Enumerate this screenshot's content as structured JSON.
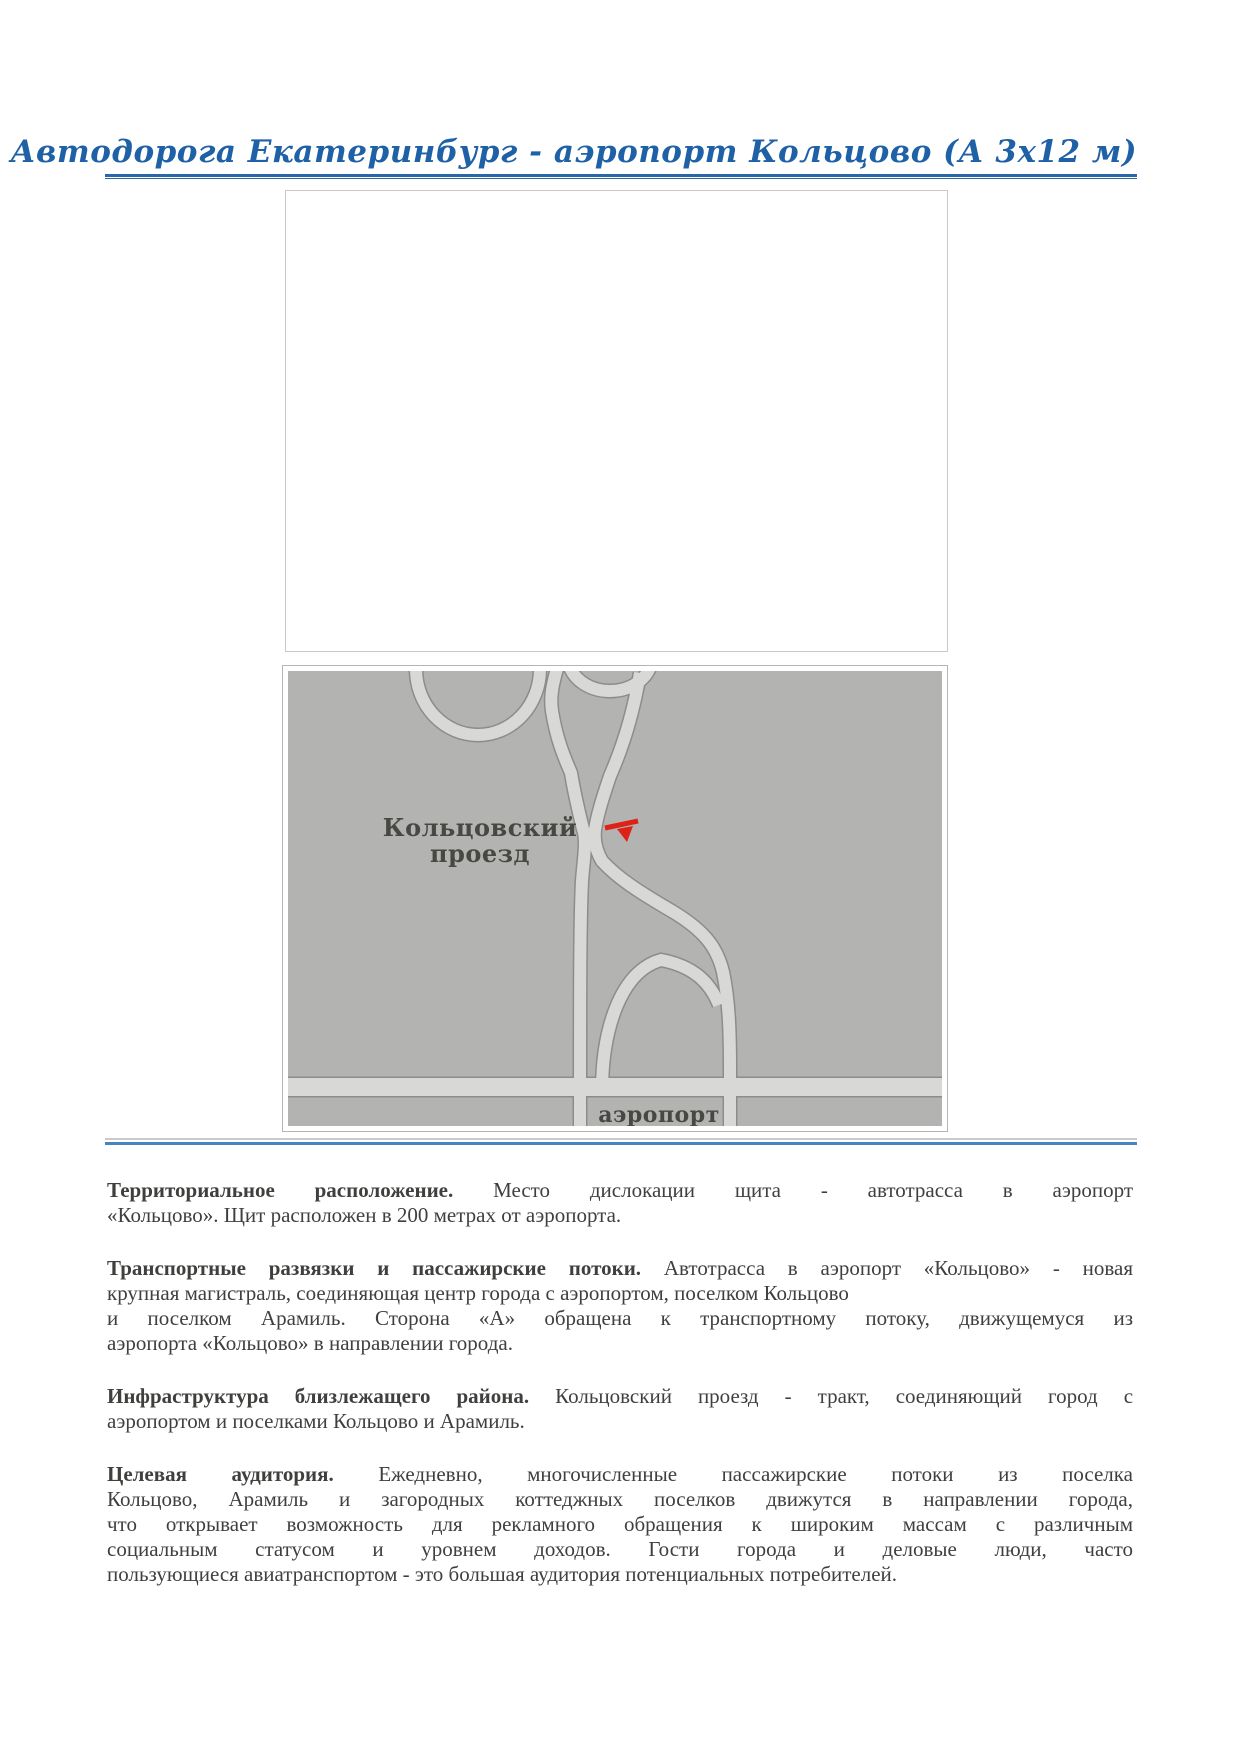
{
  "header": {
    "title": "Автодорога Екатеринбург - аэропорт Кольцово (А 3х12 м)",
    "title_color": "#1f61a6",
    "rule_color": "#2a67a6"
  },
  "map": {
    "road_label_line1": "Кольцовский",
    "road_label_line2": "проезд",
    "airport_label": "аэропорт",
    "colors": {
      "background": "#b3b3b1",
      "road_fill": "#d8d8d6",
      "road_casing": "#8c8c8a",
      "marker": "#dd2318",
      "label_text": "#474743"
    }
  },
  "separator": {
    "gray": "#cacaca",
    "blue": "#4683bf"
  },
  "body": {
    "paragraphs": [
      {
        "heading": "Территориальное расположение.",
        "lines": [
          "Место дислокации щита - автотрасса в аэропорт",
          "«Кольцово». Щит расположен в 200 метрах от аэропорта."
        ]
      },
      {
        "heading": "Транспортные развязки и пассажирские потоки.",
        "lines": [
          "Автотрасса в аэропорт «Кольцово» - новая",
          "крупная магистраль, соединяющая центр города с аэропортом, поселком Кольцово",
          "и поселком Арамиль. Сторона «А» обращена к транспортному потоку, движущемуся из",
          "аэропорта «Кольцово» в направлении города."
        ]
      },
      {
        "heading": "Инфраструктура близлежащего района.",
        "lines": [
          "Кольцовский проезд - тракт, соединяющий город с",
          "аэропортом и поселками Кольцово и Арамиль."
        ]
      },
      {
        "heading": "Целевая аудитория.",
        "lines": [
          "Ежедневно, многочисленные пассажирские потоки из поселка",
          "Кольцово, Арамиль и загородных коттеджных поселков движутся в направлении города,",
          "что открывает возможность для рекламного обращения к широким массам с различным",
          "социальным статусом и уровнем доходов. Гости города и деловые люди, часто",
          "пользующиеся авиатранспортом - это большая аудитория потенциальных потребителей."
        ]
      }
    ]
  }
}
